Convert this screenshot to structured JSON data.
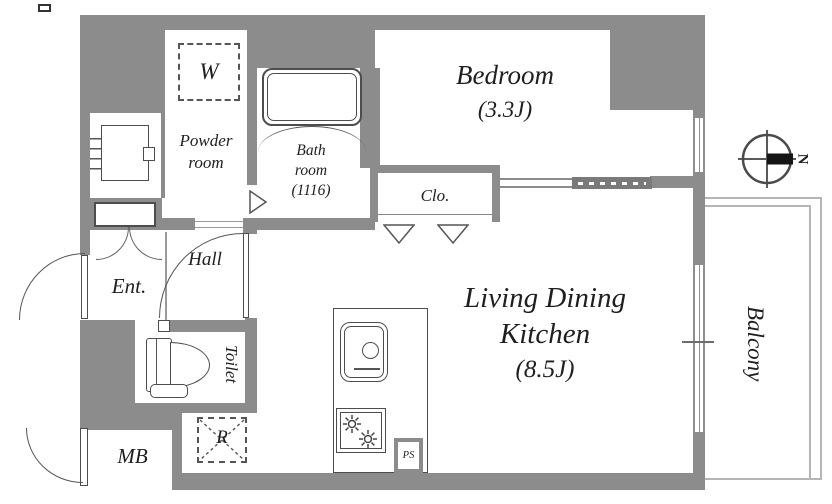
{
  "plan": {
    "bedroom": {
      "name": "Bedroom",
      "size": "(3.3J)"
    },
    "living": {
      "line1": "Living Dining",
      "line2": "Kitchen",
      "size": "(8.5J)"
    },
    "bathroom": {
      "line1": "Bath",
      "line2": "room",
      "line3": "(1116)"
    },
    "powder_room": {
      "line1": "Powder",
      "line2": "room"
    },
    "closet": {
      "label": "Clo."
    },
    "entrance": {
      "label": "Ent."
    },
    "hall": {
      "label": "Hall"
    },
    "toilet": {
      "label": "Toilet"
    },
    "balcony": {
      "label": "Balcony"
    },
    "meter_box": {
      "label": "MB"
    },
    "washer_space": {
      "label": "W"
    },
    "refrigerator_space": {
      "label": "R"
    },
    "pipe_space": {
      "label": "PS"
    },
    "compass": {
      "north": "N"
    }
  },
  "colors": {
    "wall": "#8c8c8c",
    "fixture_line": "#4d4d4d",
    "balcony_line": "#b5b5b5",
    "text": "#1f1f1f"
  }
}
